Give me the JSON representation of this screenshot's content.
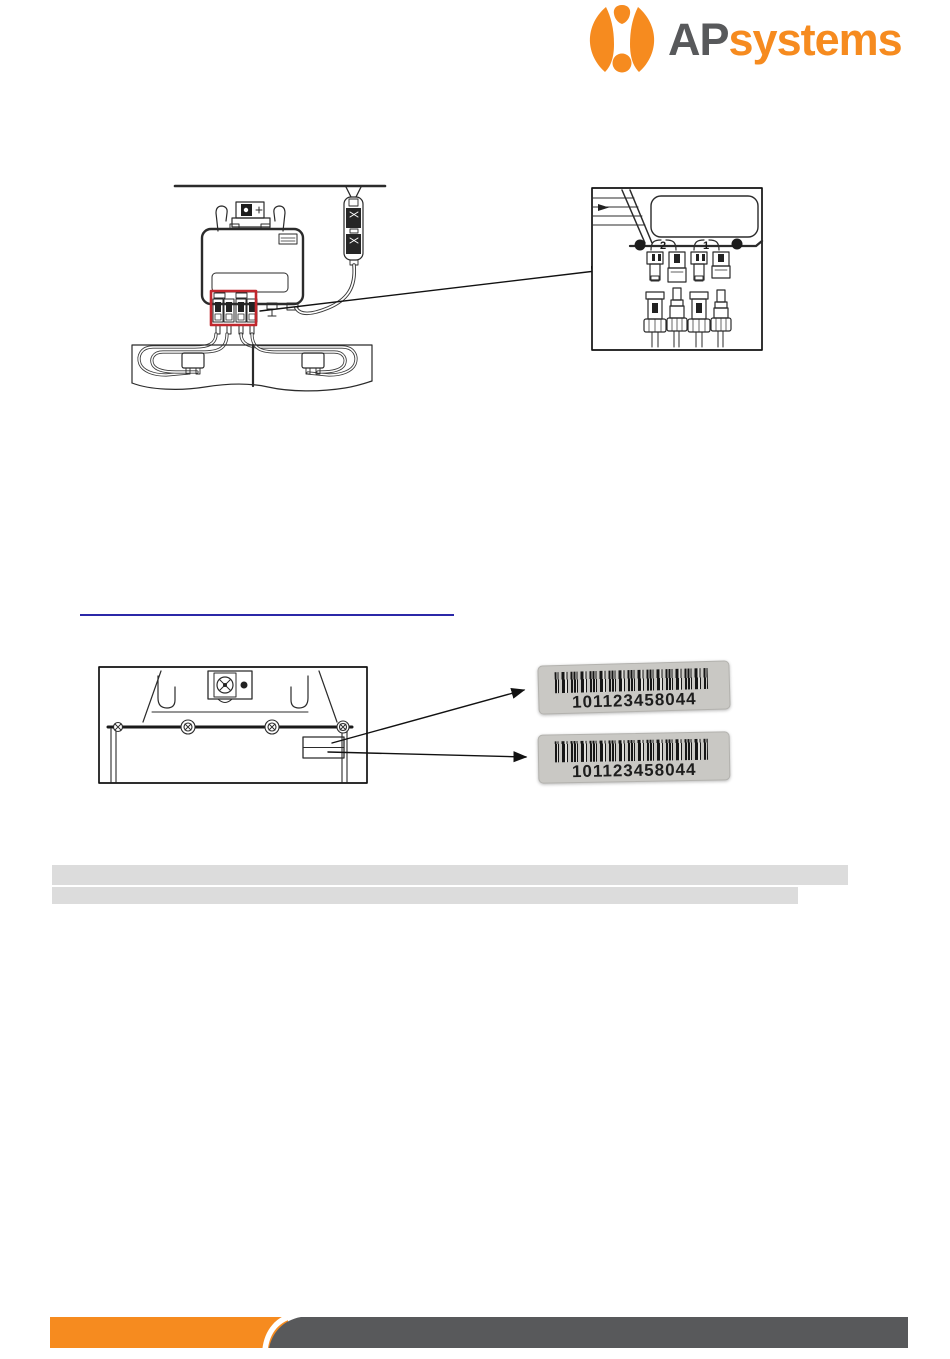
{
  "theme": {
    "brand-orange": "#F68B1F",
    "brand-gray": "#58595B",
    "highlight-red": "#C1272D",
    "link-blue": "#2B28A8",
    "banner-gray": "#DCDCDC",
    "label-bg": "#C9C8C4",
    "line-ink": "#2B2B2B"
  },
  "header": {
    "logo_ap": "AP",
    "logo_systems": "systems"
  },
  "figure_installation": {
    "detail_port_2": "2",
    "detail_port_1": "1"
  },
  "serial_labels": [
    {
      "serial": "101123458044"
    },
    {
      "serial": "101123458044"
    }
  ]
}
